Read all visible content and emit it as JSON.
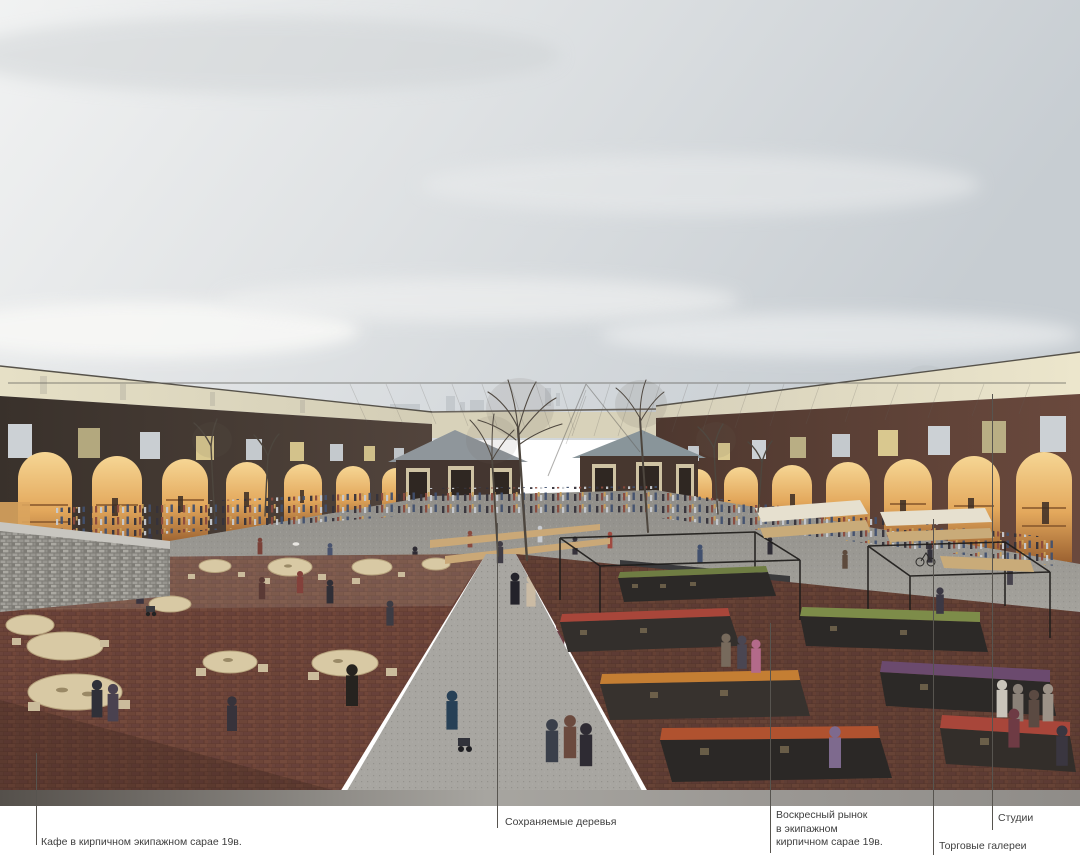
{
  "annotations": {
    "cafe": {
      "label": "Кафе в кирпичном экипажном сарае 19в."
    },
    "trees": {
      "label": "Сохраняемые деревья"
    },
    "market": {
      "lines": [
        "Воскресный рынок",
        "в экипажном",
        "кирпичном сарае 19в."
      ]
    },
    "galleries": {
      "label": "Торговые галереи"
    },
    "studios": {
      "label": "Студии"
    }
  },
  "palette": {
    "background": "#ffffff",
    "sky": "#d7dcdf",
    "cream_band": "#e0dac0",
    "brick_dark_wing": "#463831",
    "brick_red_wing": "#63453a",
    "arch_glow": "#e8b264",
    "courtyard_paving": "#9c9a94",
    "brick_paving": "#6b4237",
    "shed_roof": "#8f969b",
    "callout_line": "#57544f",
    "label_text": "#3e3e3e"
  }
}
